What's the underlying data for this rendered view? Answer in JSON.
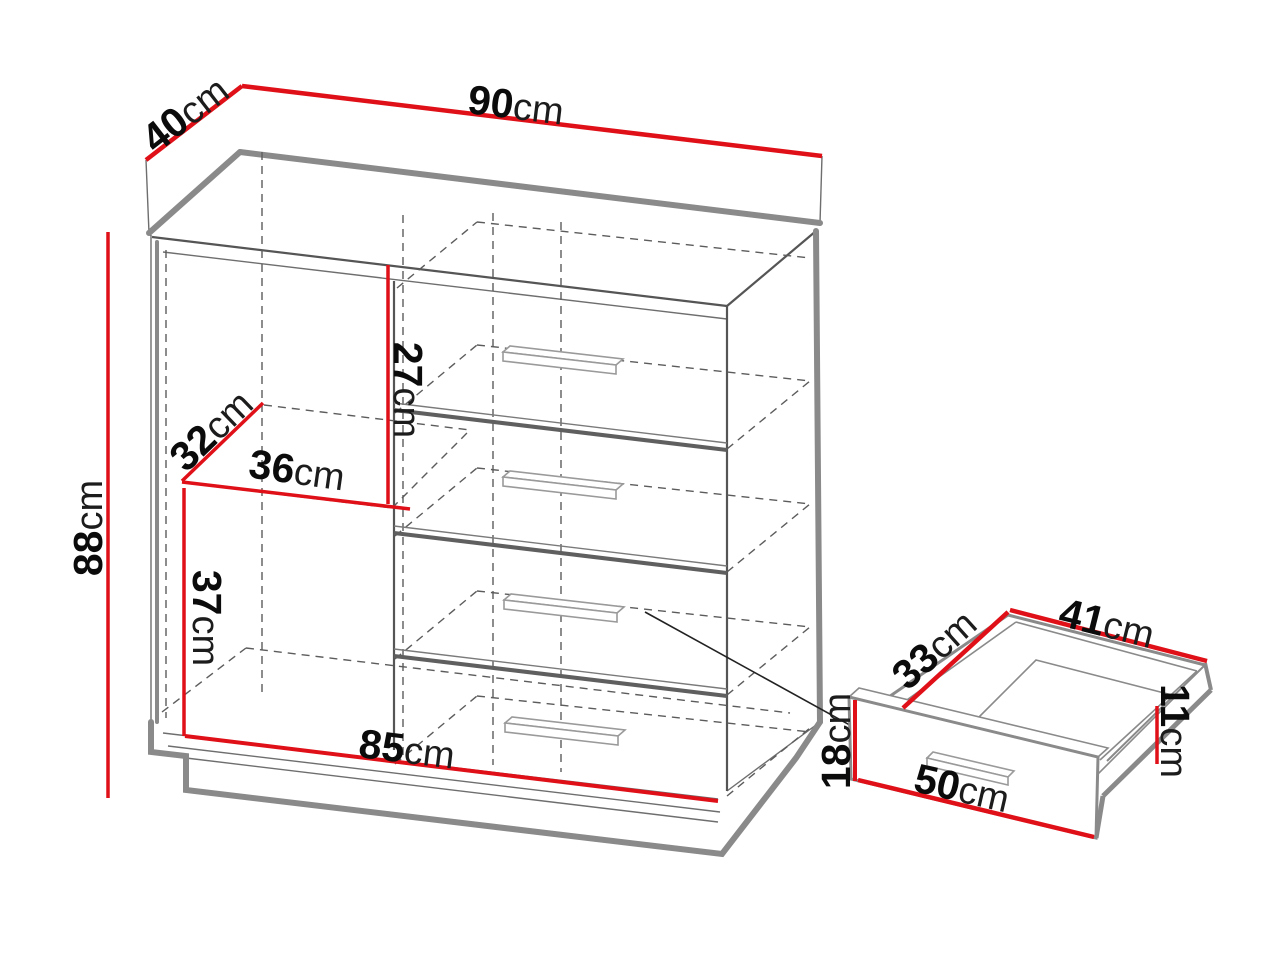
{
  "diagram": {
    "kind": "furniture-dimension-drawing",
    "unit": "cm",
    "colors": {
      "dimension_line": "#e01018",
      "outline_shadow": "#8a8a8a",
      "outline_dark": "#555555"
    },
    "cabinet": {
      "top_width": {
        "value": "90",
        "unit": "cm"
      },
      "top_depth": {
        "value": "40",
        "unit": "cm"
      },
      "height": {
        "value": "88",
        "unit": "cm"
      },
      "drawer_inner_height": {
        "value": "27",
        "unit": "cm"
      },
      "shelf_depth": {
        "value": "32",
        "unit": "cm"
      },
      "shelf_width": {
        "value": "36",
        "unit": "cm"
      },
      "compartment_height": {
        "value": "37",
        "unit": "cm"
      },
      "base_width": {
        "value": "85",
        "unit": "cm"
      }
    },
    "drawer_detail": {
      "side_depth": {
        "value": "33",
        "unit": "cm"
      },
      "back_width": {
        "value": "41",
        "unit": "cm"
      },
      "side_height": {
        "value": "11",
        "unit": "cm"
      },
      "front_height": {
        "value": "18",
        "unit": "cm"
      },
      "front_width": {
        "value": "50",
        "unit": "cm"
      }
    }
  }
}
